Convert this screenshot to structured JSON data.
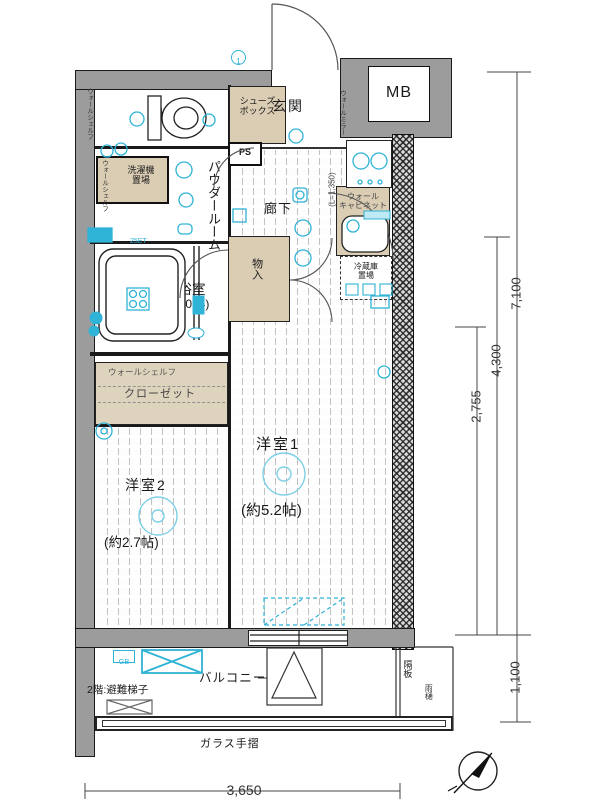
{
  "colors": {
    "accent_cyan": "#2fb3d6",
    "wall_gray": "#9c9c9c",
    "fixture_beige": "#dacdb4",
    "line_black": "#1a1a1a"
  },
  "plan": {
    "rooms": {
      "toilet": {
        "label": "トイレ",
        "shelf": "ウォールシェルフ"
      },
      "entrance": {
        "label": "玄関",
        "mirror": "ウォールミラー",
        "shoes_line1": "シューズ",
        "shoes_line2": "ボックス",
        "marker": "1"
      },
      "meter_box": "MB",
      "pipe_space": "PS",
      "powder_room": {
        "label": "パウダールーム",
        "laundry_line1": "洗濯機",
        "laundry_line2": "置場",
        "laundry_shelf": "ウォールシェルフ",
        "outlet_note": "25ET"
      },
      "bathroom": {
        "line1": "浴室",
        "line2": "(1014)"
      },
      "hallway": "廊下",
      "storage": "物入",
      "kitchen": {
        "length_note": "(L=1,350)",
        "cabinet_line1": "ウォール",
        "cabinet_line2": "キャビネット",
        "fridge_line1": "冷蔵庫",
        "fridge_line2": "置場"
      },
      "room1": {
        "label": "洋室1",
        "size": "(約5.2帖)"
      },
      "room2": {
        "label": "洋室2",
        "size": "(約2.7帖)"
      },
      "closet": {
        "line1": "ウォールシェルフ",
        "line2": "クローゼット"
      }
    },
    "balcony": {
      "label": "バルコニー",
      "gb_badge": "GB",
      "escape_note": "2階:避難梯子",
      "even_floor_mark": "偶数階",
      "partition": "隔板",
      "gutter": "雨樋",
      "rail": "ガラス手摺"
    },
    "dimensions": {
      "overall_depth": "7,100",
      "room1_depth": "4,300",
      "room2_depth": "2,755",
      "balcony_depth": "1,100",
      "overall_width": "3,650"
    }
  },
  "icons": {
    "north_arrow": "compass circle with needle",
    "escape_hatch": "rectangle with X",
    "ceiling_light": "double circle",
    "even_floor_hatch": "triangle in box"
  }
}
